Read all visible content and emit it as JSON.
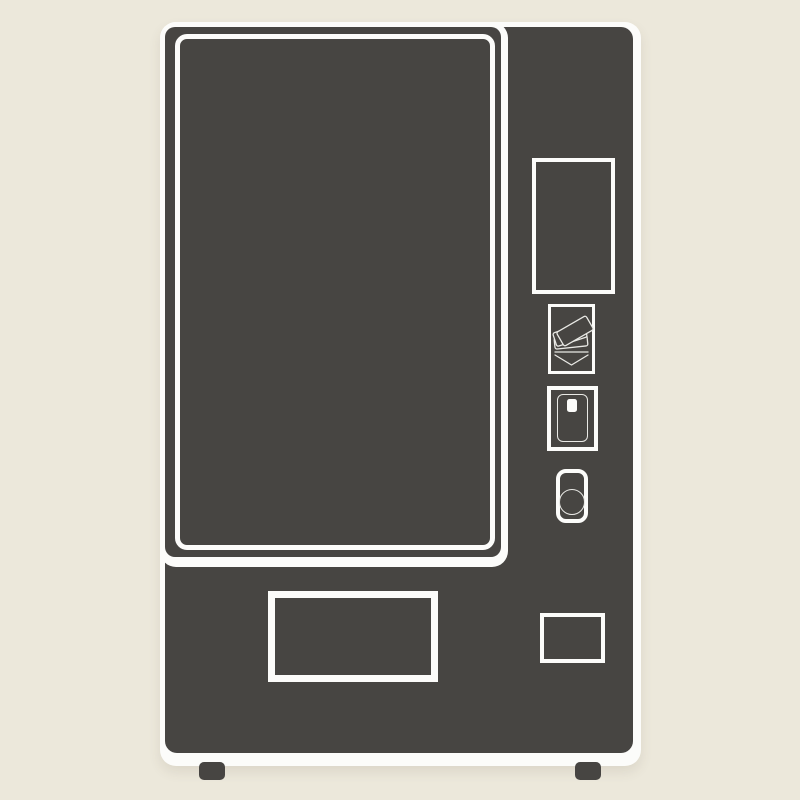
{
  "illustration": {
    "subject": "vending-machine",
    "style": "flat vector clipart, no text"
  },
  "colors": {
    "background": "#ece8db",
    "body": "#474542",
    "outline": "#fcfcfa",
    "thin_line": "#e9e9e5"
  },
  "machine": {
    "parts": [
      "product-window",
      "display-panel",
      "bill-acceptor",
      "card-reader",
      "coin-slot",
      "coin-return",
      "dispensing-tray",
      "feet"
    ]
  },
  "icons": [
    "banknotes-icon",
    "insert-arrow-icon",
    "credit-card-icon",
    "card-chip-icon",
    "coin-icon"
  ]
}
